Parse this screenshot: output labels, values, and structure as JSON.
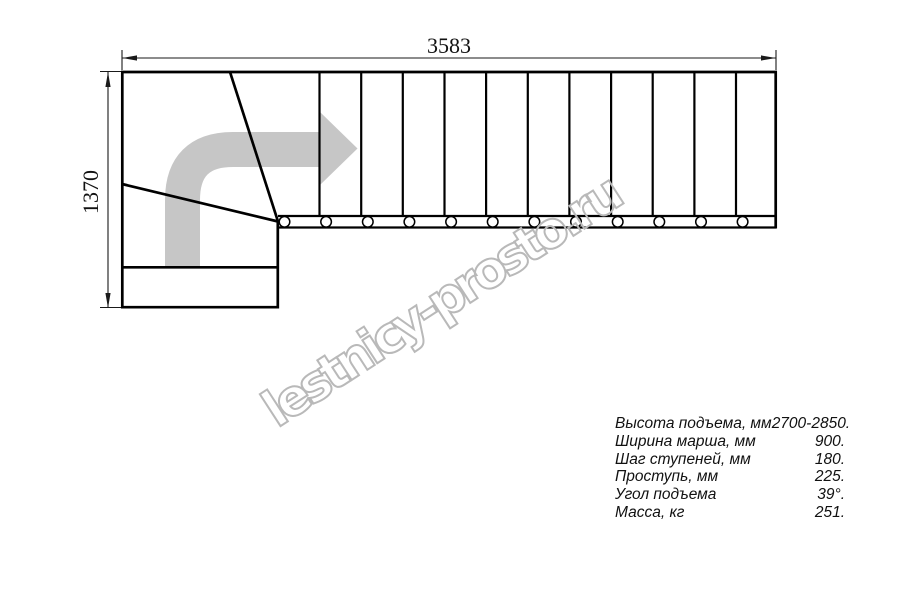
{
  "drawing": {
    "title": "stair-plan-top-view",
    "dim_width_label": "3583",
    "dim_height_label": "1370",
    "watermark": "lestnicy-prosto.ru",
    "colors": {
      "line": "#000000",
      "dimension_line": "#1a1a1a",
      "direction_arrow": "#c6c6c6",
      "watermark_outline": "#b9b9b9",
      "background": "#ffffff"
    }
  },
  "specs": {
    "rows": [
      {
        "label": "Высота подъема, мм",
        "value": "2700-2850."
      },
      {
        "label": "Ширина марша, мм",
        "value": "900."
      },
      {
        "label": "Шаг ступеней, мм",
        "value": "180."
      },
      {
        "label": "Проступь, мм",
        "value": "225."
      },
      {
        "label": "Угол подъема",
        "value": "39°."
      },
      {
        "label": "Масса, кг",
        "value": "251."
      }
    ]
  }
}
